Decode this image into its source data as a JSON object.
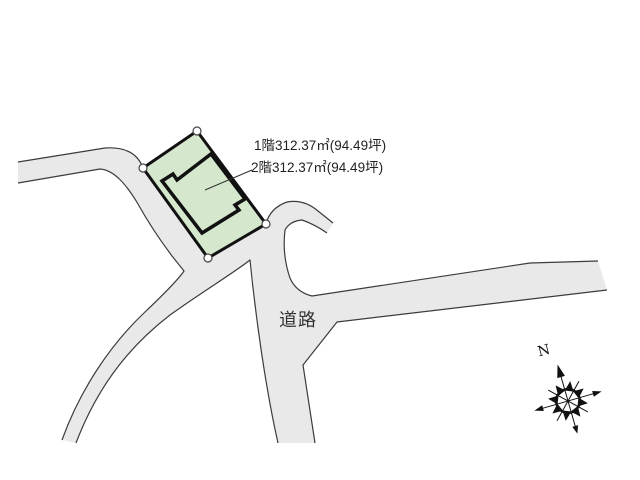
{
  "labels": {
    "floor1": "1階312.37㎡(94.49坪)",
    "floor2": "2階312.37㎡(94.49坪)",
    "road": "道路",
    "compass_north": "N"
  },
  "colors": {
    "background": "#ffffff",
    "road_fill": "#e9e9e9",
    "road_outline": "#3c3c3c",
    "plot_fill": "#d5e8cd",
    "plot_border": "#111111",
    "building_outline": "#111111",
    "corner_marker_fill": "#ffffff",
    "corner_marker_stroke": "#444444",
    "leader_line": "#333333",
    "text": "#222222"
  }
}
